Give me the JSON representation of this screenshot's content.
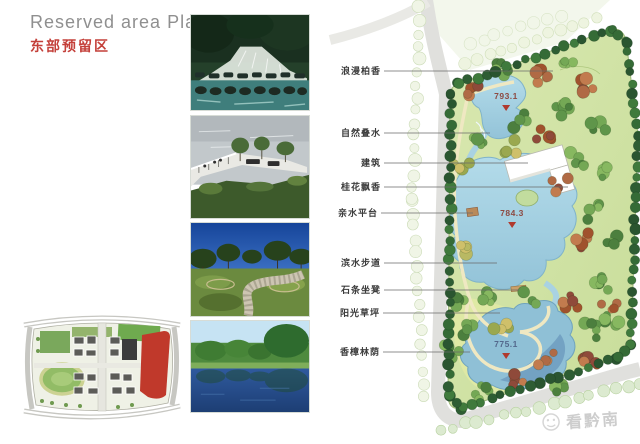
{
  "header": {
    "title_en": "Reserved area Plan",
    "title_zh": "东部预留区"
  },
  "plan": {
    "callouts": [
      {
        "text": "浪漫柏香"
      },
      {
        "text": "自然叠水"
      },
      {
        "text": "建筑"
      },
      {
        "text": "桂花飘香"
      },
      {
        "text": "亲水平台"
      },
      {
        "text": "滨水步道"
      },
      {
        "text": "石条坐凳"
      },
      {
        "text": "阳光草坪"
      },
      {
        "text": "香樟林荫"
      }
    ],
    "elevations": [
      {
        "value": "793.1"
      },
      {
        "value": "784.3"
      },
      {
        "value": "775.1"
      }
    ],
    "colors": {
      "accent_red": "#c4403a",
      "water": "#a9d2e2",
      "site_lawn": "#cfe3a2",
      "border_tree": "#2e5d33",
      "road": "#e0e0dd",
      "overview_highlight": "#c0392b",
      "marker_triangle": "#b03a2e"
    }
  },
  "watermark": {
    "text": "看黔南"
  }
}
